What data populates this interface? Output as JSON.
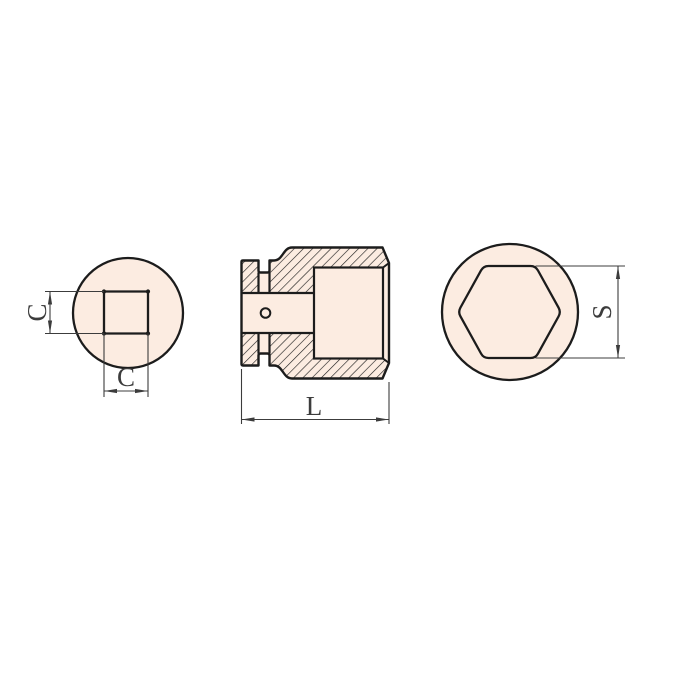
{
  "labels": {
    "square_side": "C",
    "square_width": "C",
    "length": "L",
    "hex_width": "S"
  },
  "colors": {
    "part_fill": "#FCECE1",
    "outline": "#1C1C1C",
    "dimension": "#3C3C3C",
    "background": "#FFFFFF"
  }
}
